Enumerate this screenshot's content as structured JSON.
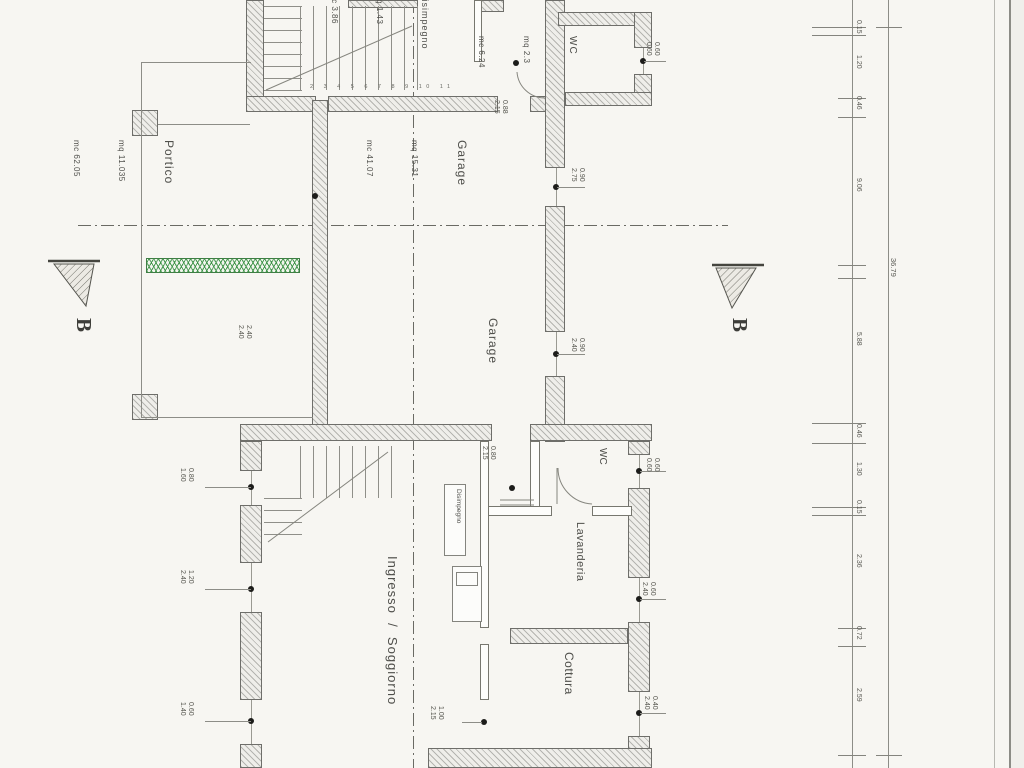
{
  "plan": {
    "rooms": {
      "portico": {
        "name": "Portico",
        "area": "mq 11.035",
        "volume": "mc 62.05"
      },
      "disimpegno_top": {
        "name": "Disimpegno",
        "area": "mq 1.43",
        "volume": "mc 3.86"
      },
      "wc_top": {
        "name": "WC",
        "area": "mq 2.3",
        "volume": "mc 6.24"
      },
      "garage_top": {
        "name": "Garage",
        "area": "mq 15.31",
        "volume": "mc 41.07"
      },
      "garage_main": {
        "name": "Garage"
      },
      "ingresso": {
        "name": "Ingresso  /  Soggiorno"
      },
      "disimpegno_bottom": {
        "name": "Disimpegno"
      },
      "wc_bottom": {
        "name": "WC"
      },
      "lavanderia": {
        "name": "Lavanderia"
      },
      "cottura": {
        "name": "Cottura"
      }
    },
    "section": {
      "label_left": "B",
      "label_right": "B"
    },
    "stairs": {
      "tread_numbers": "2 3 4 5 6 7 8 9 10 11"
    },
    "openings": [
      {
        "id": "garage-top-door",
        "w": "0.88",
        "h": "2.15"
      },
      {
        "id": "garage-upper-window",
        "w": "0.90",
        "h": "2.75"
      },
      {
        "id": "portico-opening",
        "w": "2.40",
        "h": "2.40"
      },
      {
        "id": "garage-side-window",
        "w": "0.90",
        "h": "2.40"
      },
      {
        "id": "hall-door",
        "w": "0.80",
        "h": "2.15"
      },
      {
        "id": "wc-bottom-window",
        "w": "0.60",
        "h": "0.60"
      },
      {
        "id": "soggiorno-window-1",
        "w": "0.80",
        "h": "1.60"
      },
      {
        "id": "soggiorno-window-2",
        "w": "1.20",
        "h": "2.40"
      },
      {
        "id": "soggiorno-window-3",
        "w": "0.60",
        "h": "1.40"
      },
      {
        "id": "lavanderia-window",
        "w": "0.60",
        "h": "2.40"
      },
      {
        "id": "cottura-window",
        "w": "0.40",
        "h": "2.40"
      },
      {
        "id": "cottura-door",
        "w": "1.00",
        "h": "2.15"
      },
      {
        "id": "wc-top-window",
        "w": "0.60",
        "h": "0.60"
      }
    ],
    "dimension_chain": {
      "segments": [
        "0.15",
        "1.20",
        "0.46",
        "9.06",
        "5.88",
        "0.46",
        "1.30",
        "0.15",
        "2.36",
        "0.72",
        "2.59"
      ],
      "total": "36.79"
    }
  }
}
